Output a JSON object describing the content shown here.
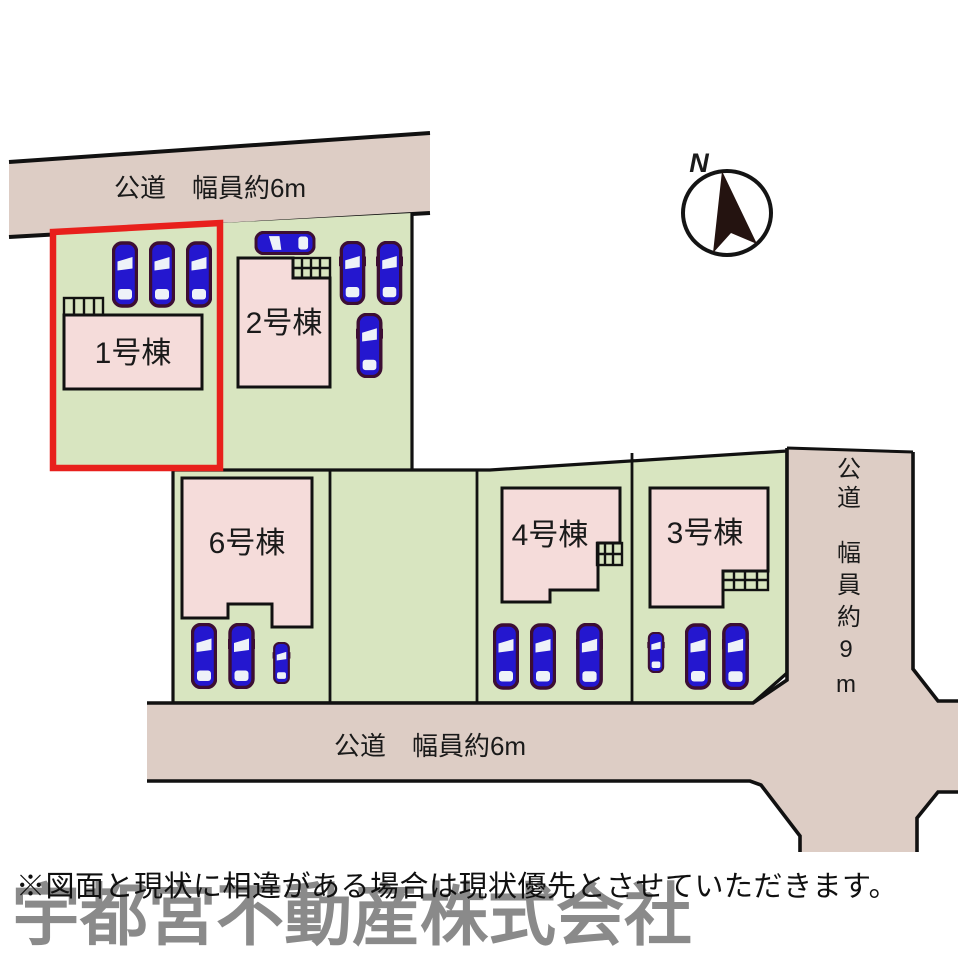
{
  "compass": {
    "label": "N"
  },
  "roads": {
    "top": {
      "label": "公道　幅員約6m"
    },
    "bottom": {
      "label": "公道　幅員約6m"
    },
    "right": {
      "label_top": "公道",
      "label_bottom": "幅員約9m"
    }
  },
  "plots": {
    "plot1": {
      "label": "1号棟",
      "highlighted": true
    },
    "plot2": {
      "label": "2号棟",
      "highlighted": false
    },
    "plot3": {
      "label": "3号棟",
      "highlighted": false
    },
    "plot4": {
      "label": "4号棟",
      "highlighted": false
    },
    "plot6": {
      "label": "6号棟",
      "highlighted": false
    }
  },
  "footer": {
    "disclaimer": "※図面と現状に相違がある場合は現状優先とさせていただきます。",
    "company": "宇都宮不動産株式会社"
  },
  "colors": {
    "plot_green": "#d8e5c0",
    "road_tan": "#ddcdc5",
    "building_pink": "#f5dcda",
    "car_blue": "#2417cf",
    "car_outline": "#3c0e33",
    "highlight_red": "#e8201c"
  }
}
